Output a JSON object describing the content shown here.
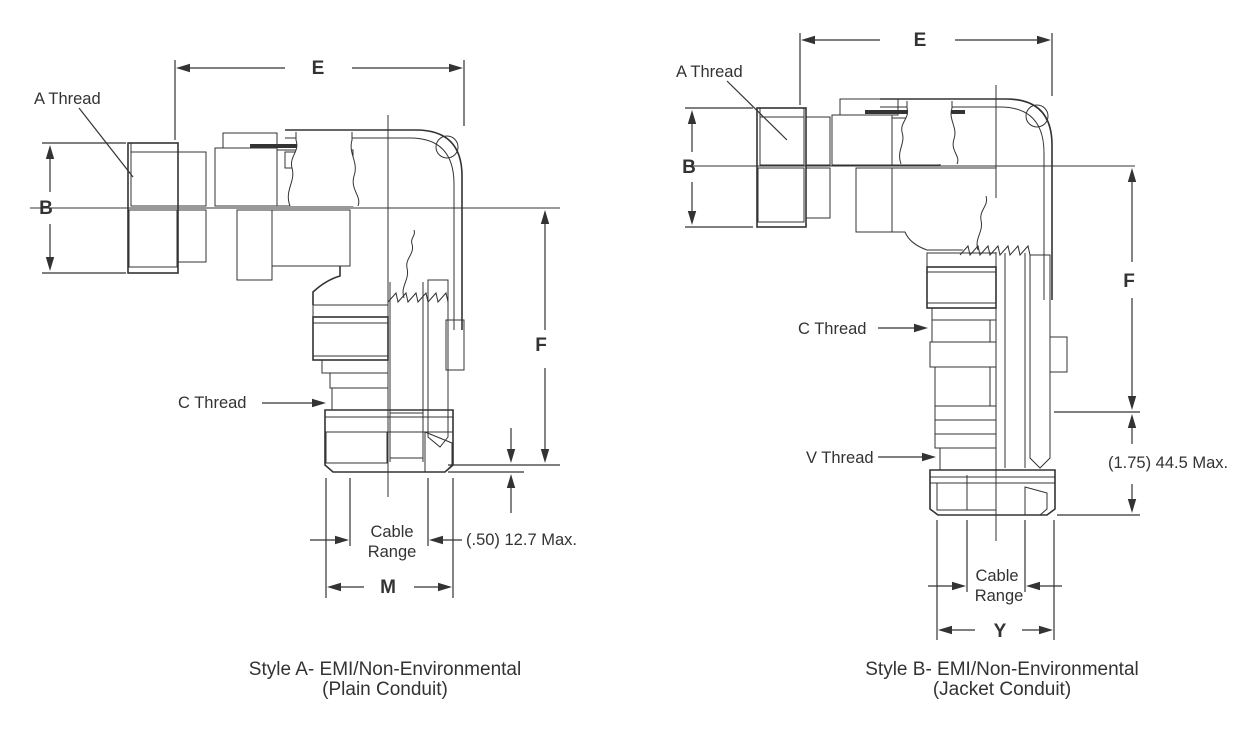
{
  "drawing": {
    "line_color": "#333333",
    "background_color": "#ffffff"
  },
  "figures": {
    "style_a": {
      "caption_line1": "Style A- EMI/Non-Environmental",
      "caption_line2": "(Plain Conduit)",
      "labels": {
        "a_thread": "A Thread",
        "c_thread": "C Thread",
        "cable_line1": "Cable",
        "cable_line2": "Range",
        "max_note": "(.50) 12.7 Max."
      },
      "dims": {
        "e": "E",
        "b": "B",
        "f": "F",
        "m": "M"
      }
    },
    "style_b": {
      "caption_line1": "Style B- EMI/Non-Environmental",
      "caption_line2": "(Jacket Conduit)",
      "labels": {
        "a_thread": "A Thread",
        "c_thread": "C Thread",
        "v_thread": "V Thread",
        "cable_line1": "Cable",
        "cable_line2": "Range",
        "max_note": "(1.75) 44.5 Max."
      },
      "dims": {
        "e": "E",
        "b": "B",
        "f": "F",
        "y": "Y"
      }
    }
  }
}
